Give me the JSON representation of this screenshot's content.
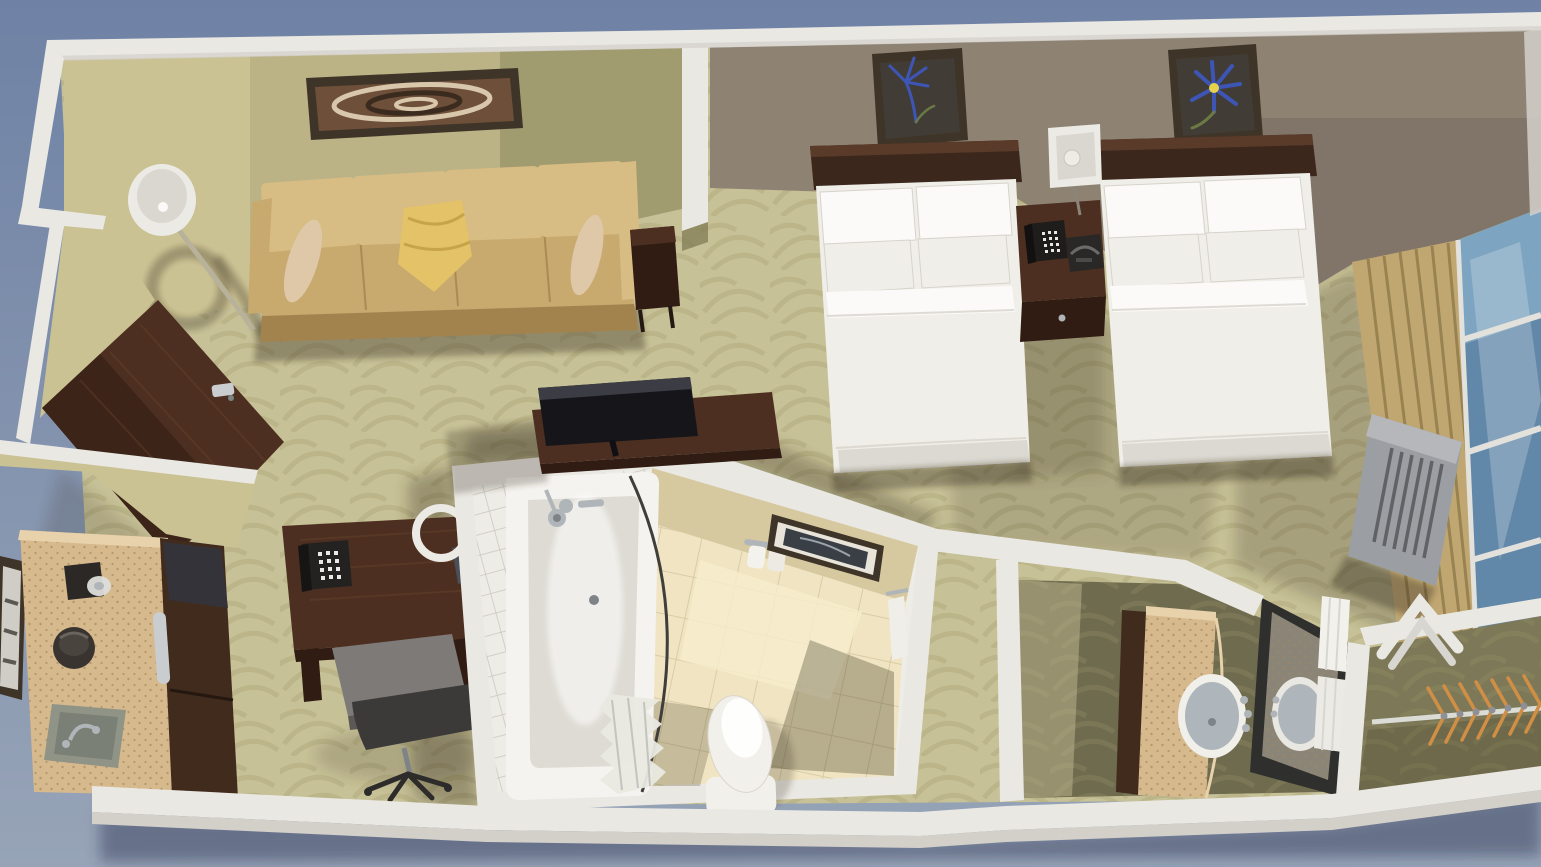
{
  "meta": {
    "description": "3D cutaway dollhouse rendering of a hotel guest-room suite viewed from above",
    "view": "top-down isometric render",
    "visible_text": "none"
  },
  "colors": {
    "bg_top": "#6F82A5",
    "bg_bottom": "#97A4B7",
    "wall_white": "#EAE8E3",
    "wall_white_shade": "#D3D0CA",
    "wall_white_dark": "#BFBCB5",
    "olive_wall_lit": "#CBC294",
    "olive_wall": "#ABA478",
    "olive_wall_shade": "#868059",
    "wall_beige": "#D6C9A0",
    "taupe_wall": "#8E8273",
    "taupe_wall_shade": "#746B5E",
    "carpet": "#C7C197",
    "carpet_pattern": "#A9A274",
    "carpet_shade": "#8F8A64",
    "mahogany": "#4C2F20",
    "mahogany_light": "#6E4731",
    "mahogany_dark": "#301C12",
    "headboard": "#3B271C",
    "sofa_tan": "#C8A96E",
    "sofa_tan_light": "#D7BC84",
    "sofa_tan_dark": "#A3834D",
    "bolster": "#DFC8A7",
    "pillow_yellow": "#E3C268",
    "bed_white": "#F0EEE8",
    "bed_white_bright": "#FBFAF8",
    "bed_shadow": "#D6D3CB",
    "art_frame": "#3F3428",
    "art_swirl_bg": "#6E503A",
    "art_swirl_light": "#D9C7AC",
    "art_swirl_dark": "#3B2B1F",
    "flower_bg": "#413D36",
    "flower_blue": "#3D56B6",
    "flower_accent": "#E8D24A",
    "stem_green": "#6B7A44",
    "lamp_white": "#ECEAE5",
    "lamp_inner": "#DAD7D0",
    "chrome": "#AFB5B9",
    "chrome_dark": "#7D8386",
    "tile_white": "#EDECE7",
    "tile_grout": "#C9C6BD",
    "tub_white": "#F5F3EF",
    "tub_inner": "#DDDBD3",
    "floor_cream": "#F0E4C2",
    "floor_cream_lit": "#F8EECD",
    "floor_grout": "#D9CCA5",
    "toilet_white": "#F2F0EA",
    "speckle_base": "#D7B98E",
    "speckle_dot": "#AA8B5F",
    "speckle_lip": "#E8D2AB",
    "cabinet_dark": "#412B1D",
    "appliance_glass": "#35333A",
    "handle_silver": "#CACDCF",
    "window_blue": "#7DA4C0",
    "window_blue_dark": "#55799D",
    "mullion": "#E3E1DB",
    "drape": "#C0A772",
    "drape_shade": "#988250",
    "ac_gray": "#9B9EA2",
    "ac_dark": "#606266",
    "ac_light": "#B5B7BB",
    "hanger_orange": "#D08F45",
    "chair_gray": "#7E7A78",
    "chair_dark": "#3C3A38",
    "sink_gray": "#AFB6BB",
    "shadow": "rgba(46,40,18,0.36)",
    "shadow_cool": "rgba(44,54,84,0.45)",
    "shadow_strong": "rgba(30,26,12,0.5)"
  },
  "scene": {
    "rooms": [
      {
        "name": "living-area",
        "items": [
          "tan-sofa",
          "yellow-accent-pillow",
          "bolster-pillows",
          "abstract-wall-art",
          "floor-lamp",
          "dark-wood-end-table",
          "tv-console",
          "flat-screen-tv",
          "entry-door"
        ]
      },
      {
        "name": "work-area",
        "items": [
          "mahogany-desk",
          "desk-telephone",
          "ring-desk-lamp",
          "office-chair"
        ]
      },
      {
        "name": "kitchenette",
        "items": [
          "granite-counter",
          "coffee-maker",
          "ice-bucket",
          "sink",
          "microwave",
          "mini-fridge",
          "framed-art"
        ]
      },
      {
        "name": "bathroom",
        "items": [
          "bathtub",
          "shower-head",
          "curved-curtain-rod",
          "folded-shower-curtain",
          "toilet",
          "toilet-paper-holder",
          "framed-art",
          "cream-tile-floor",
          "white-tiled-shower-walls"
        ]
      },
      {
        "name": "bedroom",
        "items": [
          "double-bed-1",
          "double-bed-2",
          "dark-wood-headboards",
          "white-pillows",
          "nightstand",
          "telephone",
          "alarm-clock",
          "cube-table-lamp",
          "blue-flower-art-1",
          "blue-flower-art-2"
        ]
      },
      {
        "name": "window-wall",
        "items": [
          "tan-drapes",
          "blue-window",
          "ptac-air-conditioner",
          "luggage-rack"
        ]
      },
      {
        "name": "vanity-room",
        "items": [
          "granite-vanity-counter",
          "round-sink",
          "framed-mirror",
          "rolled-towels"
        ]
      },
      {
        "name": "closet",
        "items": [
          "clothes-rod",
          "wooden-hangers"
        ]
      }
    ]
  }
}
